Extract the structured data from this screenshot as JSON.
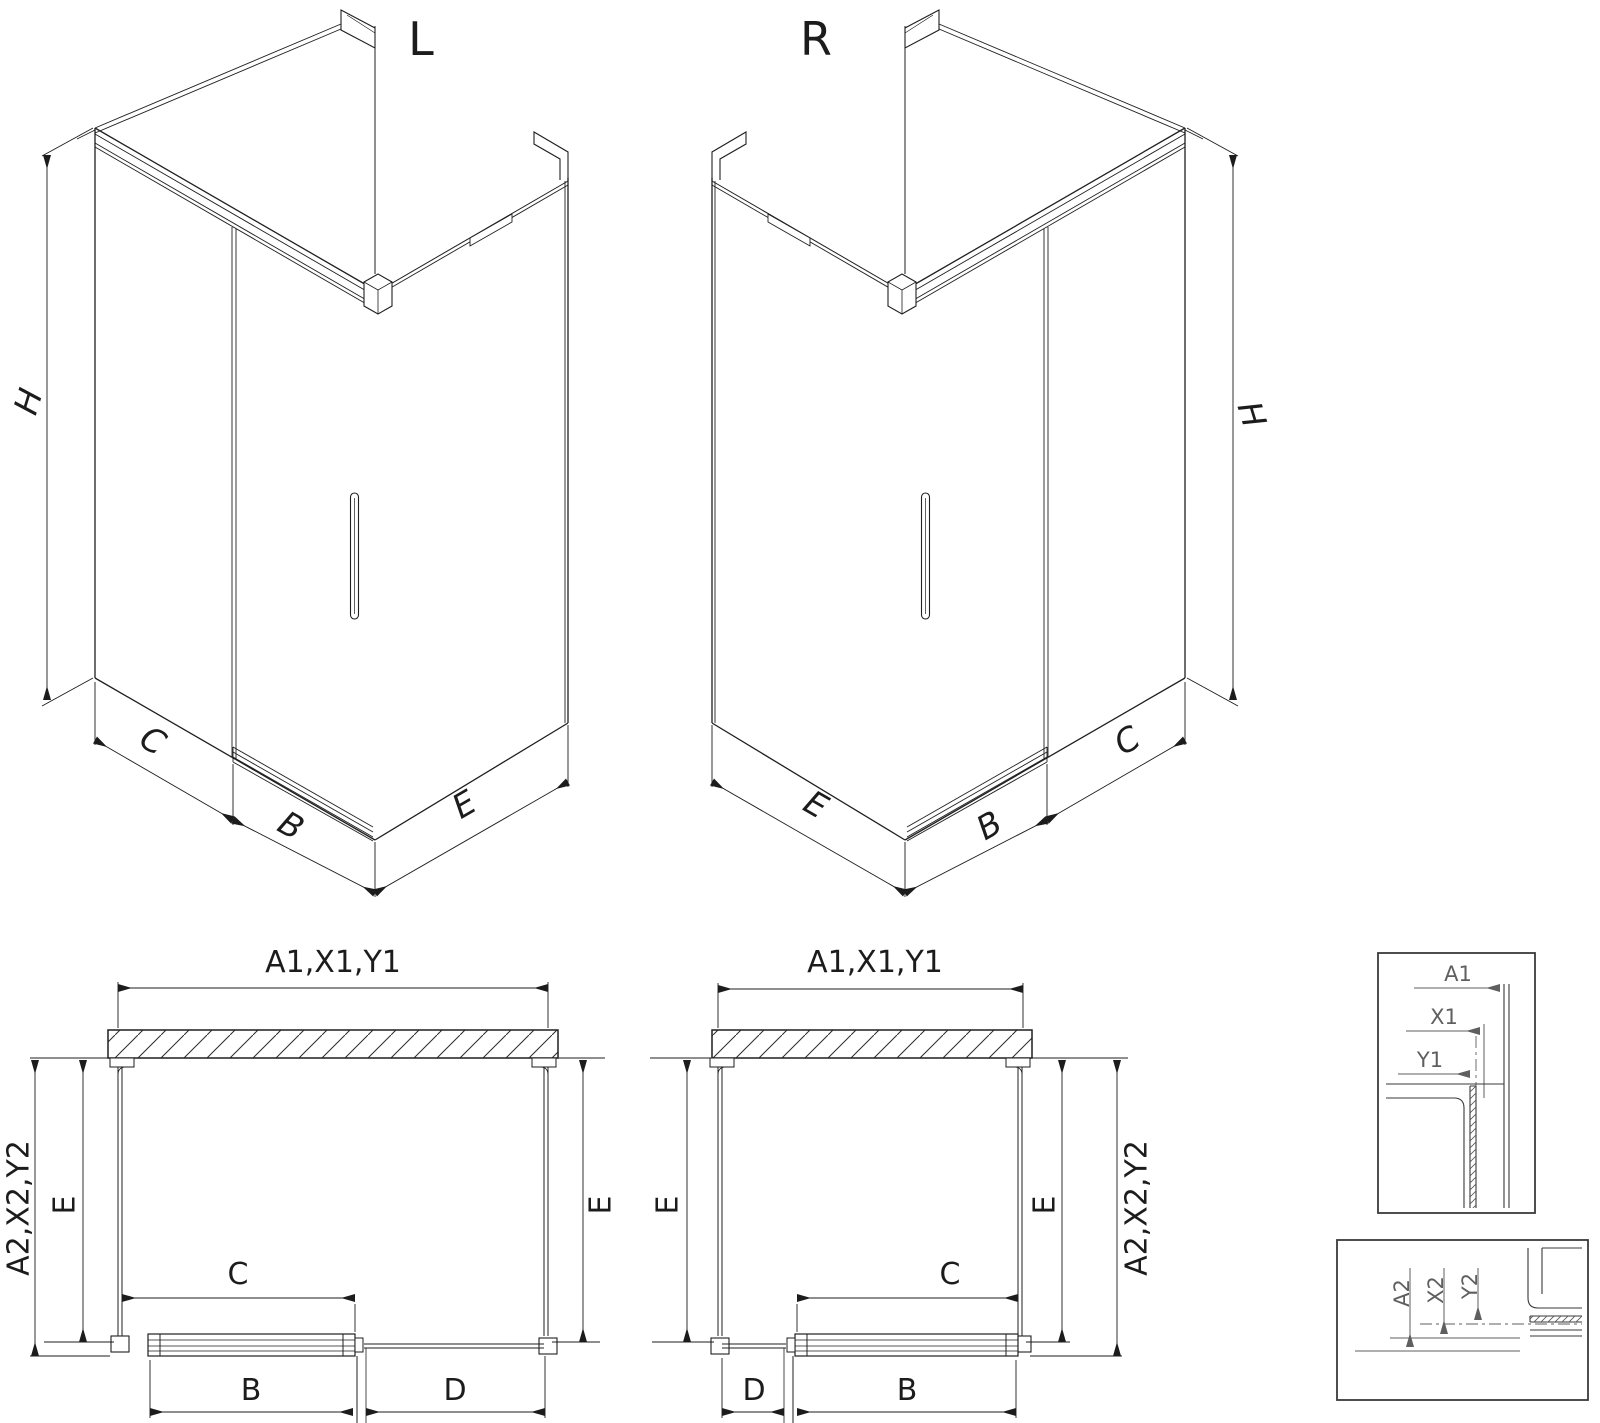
{
  "drawing": {
    "iso_left": {
      "title": "L",
      "dim_height": "H",
      "dim_fixed": "C",
      "dim_door": "B",
      "dim_side": "E"
    },
    "iso_right": {
      "title": "R",
      "dim_height": "H",
      "dim_fixed": "C",
      "dim_door": "B",
      "dim_side": "E"
    },
    "plan_left": {
      "dim_top": "A1,X1,Y1",
      "dim_left_outer": "A2,X2,Y2",
      "dim_left_inner": "E",
      "dim_right_inner": "E",
      "dim_opening": "C",
      "dim_door": "B",
      "dim_panel": "D"
    },
    "plan_right": {
      "dim_top": "A1,X1,Y1",
      "dim_right_outer": "A2,X2,Y2",
      "dim_left_inner": "E",
      "dim_right_inner": "E",
      "dim_opening": "C",
      "dim_door": "B",
      "dim_panel": "D"
    },
    "detail_top": {
      "dim_a": "A1",
      "dim_x": "X1",
      "dim_y": "Y1"
    },
    "detail_bottom": {
      "dim_a": "A2",
      "dim_x": "X2",
      "dim_y": "Y2"
    }
  }
}
